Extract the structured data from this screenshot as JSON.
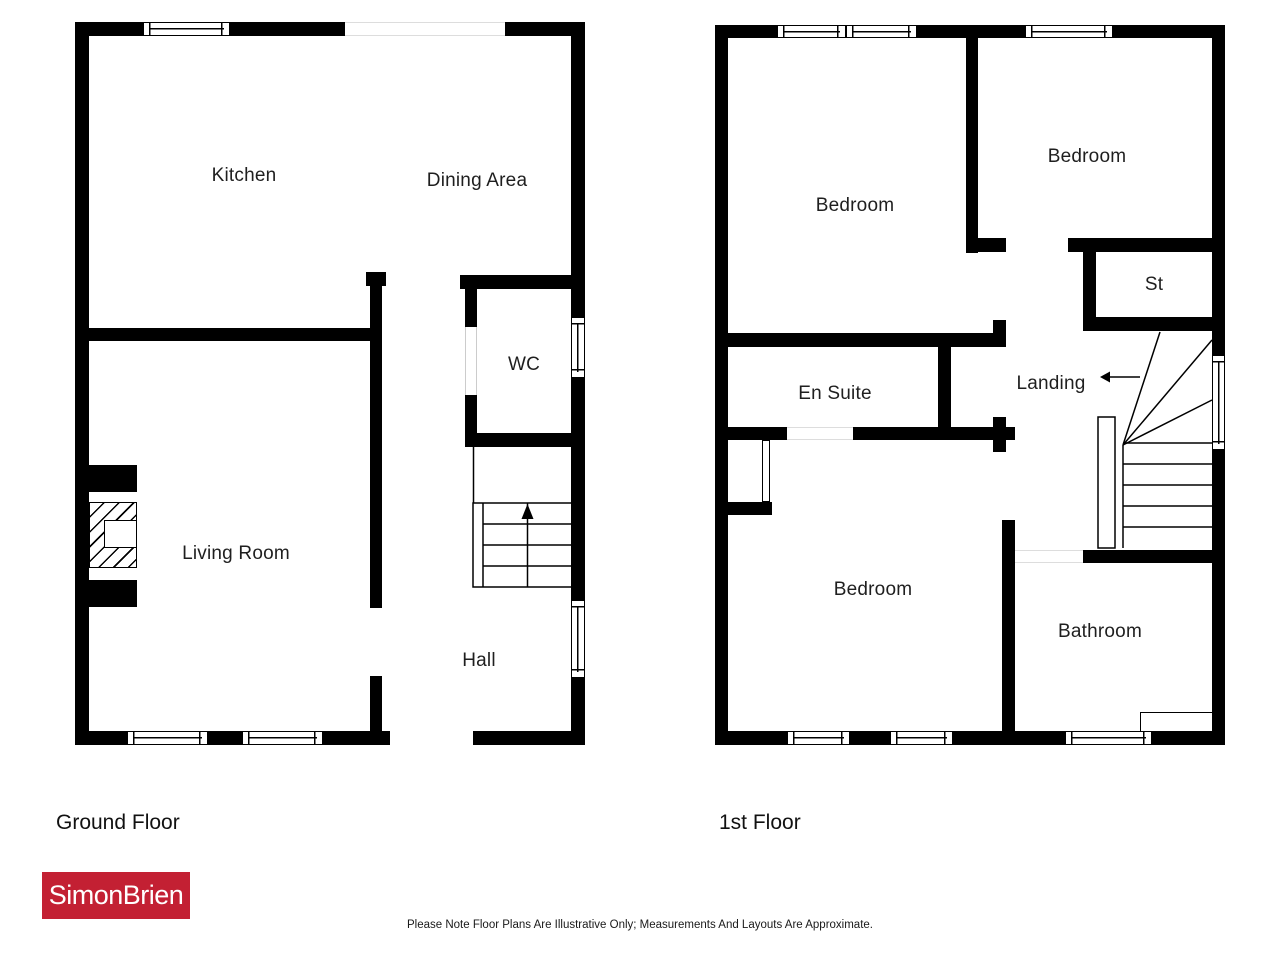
{
  "page": {
    "background": "#ffffff"
  },
  "colors": {
    "wall": "#000000",
    "label": "#1f1f1f",
    "logo_bg": "#c32033",
    "logo_text": "#ffffff"
  },
  "ground_floor": {
    "title": "Ground Floor",
    "rooms": {
      "kitchen": "Kitchen",
      "dining_area": "Dining Area",
      "wc": "WC",
      "living_room": "Living Room",
      "hall": "Hall"
    }
  },
  "first_floor": {
    "title": "1st Floor",
    "rooms": {
      "bedroom_top_left": "Bedroom",
      "bedroom_top_right": "Bedroom",
      "storage": "St",
      "en_suite": "En Suite",
      "landing": "Landing",
      "bedroom_bottom": "Bedroom",
      "bathroom": "Bathroom"
    }
  },
  "branding": {
    "agency": "SimonBrien"
  },
  "disclaimer": "Please Note Floor Plans Are Illustrative Only; Measurements And Layouts Are Approximate."
}
